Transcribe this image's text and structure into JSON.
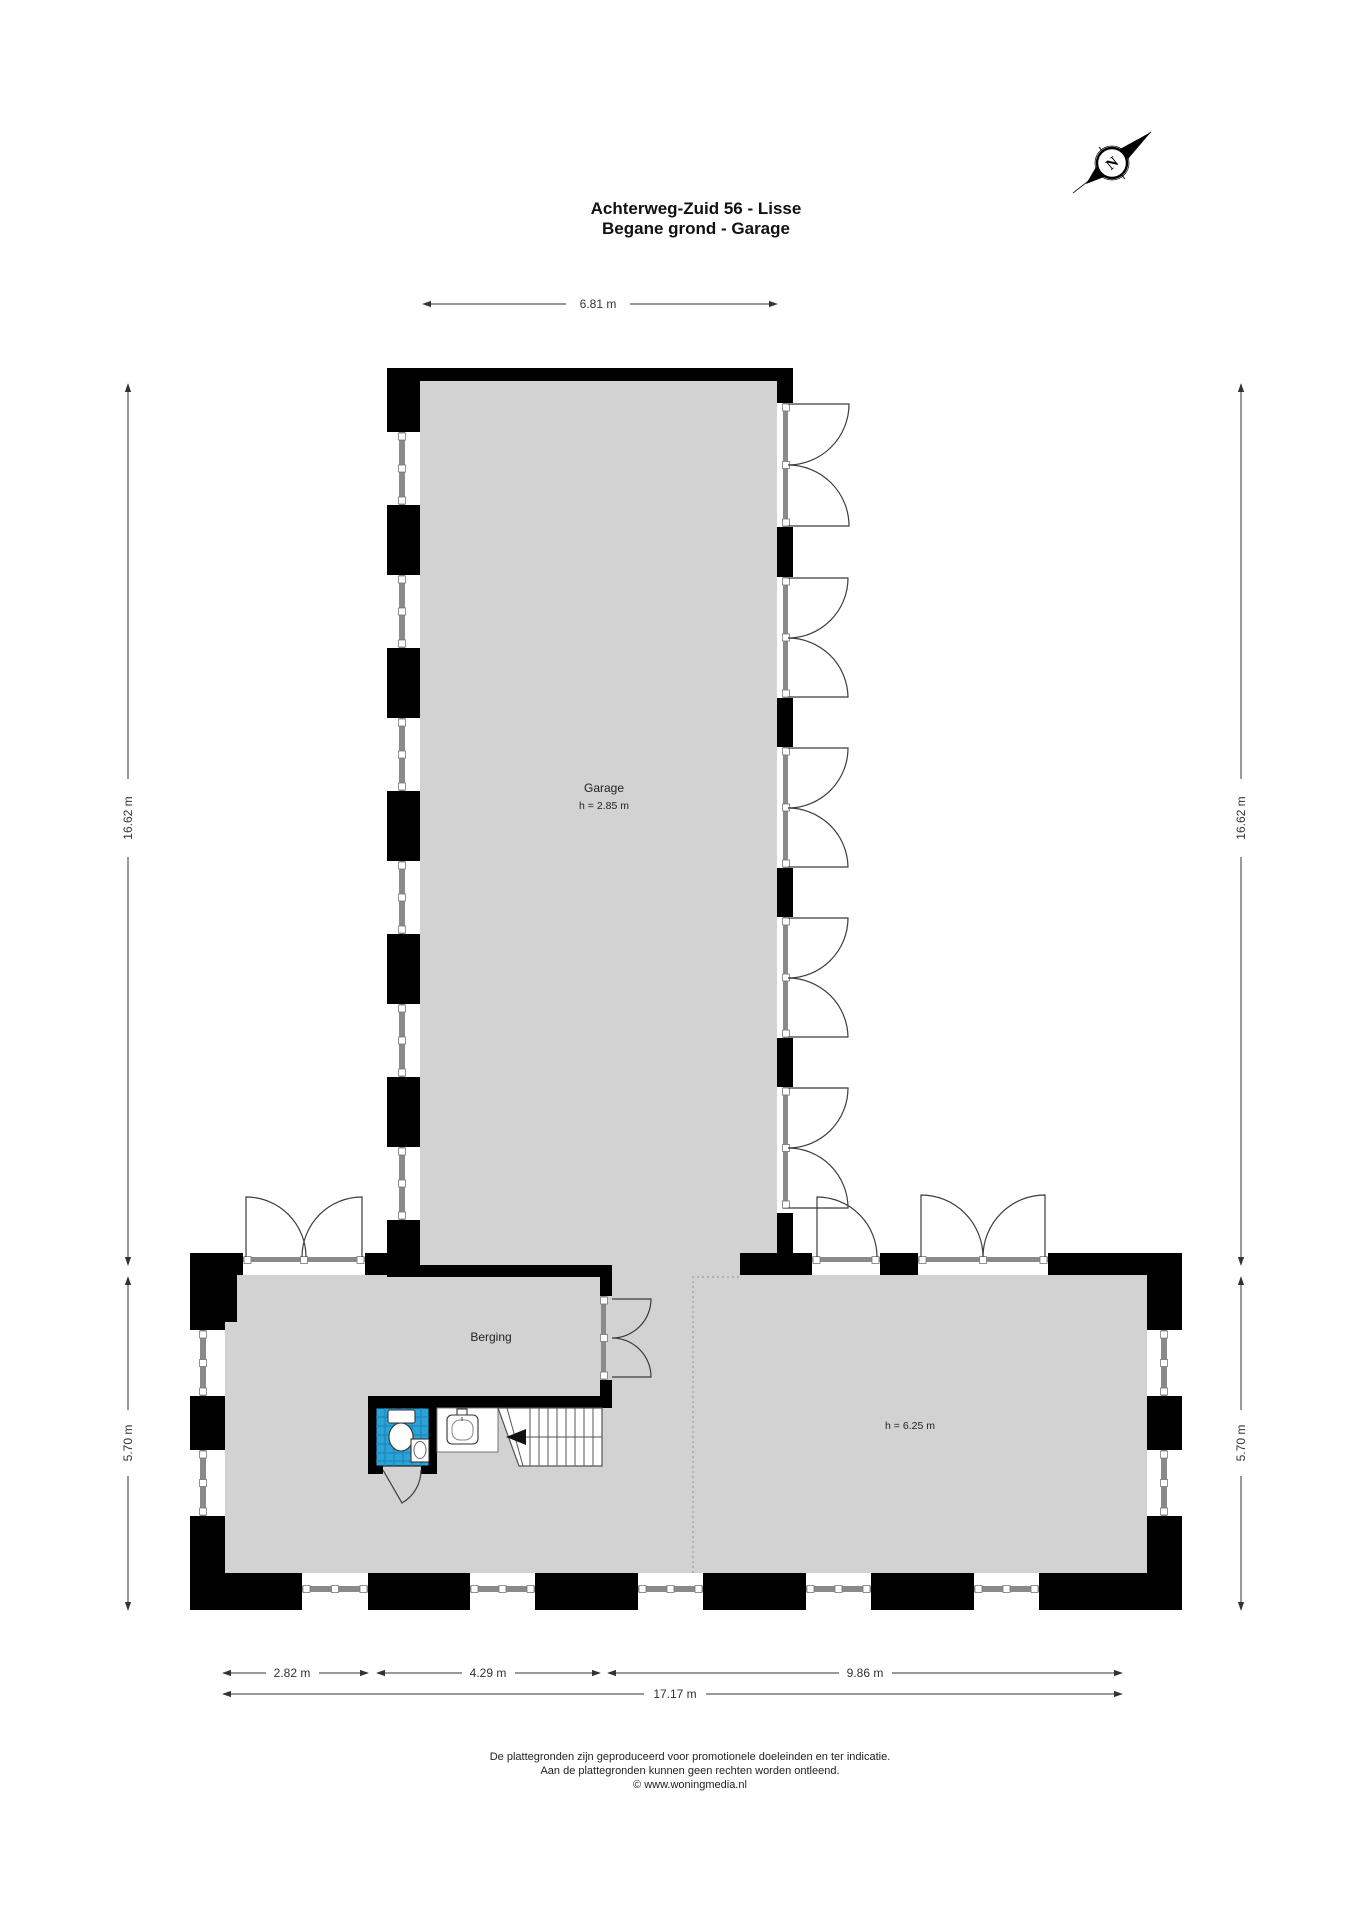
{
  "title": {
    "line1": "Achterweg-Zuid 56 - Lisse",
    "line2": "Begane grond - Garage"
  },
  "compass": {
    "label": "N"
  },
  "rooms": {
    "garage": {
      "name": "Garage",
      "height_label": "h = 2.85 m"
    },
    "berging": {
      "name": "Berging"
    },
    "main_space": {
      "height_label": "h = 6.25 m"
    }
  },
  "dimensions": {
    "top_width": "6.81 m",
    "left_upper_height": "16.62 m",
    "left_lower_height": "5.70 m",
    "right_upper_height": "16.62 m",
    "right_lower_height": "5.70 m",
    "bottom_segment_1": "2.82 m",
    "bottom_segment_2": "4.29 m",
    "bottom_segment_3": "9.86 m",
    "bottom_total": "17.17 m"
  },
  "footer": {
    "line1": "De plattegronden zijn geproduceerd voor promotionele doeleinden en ter indicatie.",
    "line2": "Aan de plattegronden kunnen geen rechten worden ontleend.",
    "line3": "© www.woningmedia.nl"
  },
  "colors": {
    "floor": "#d2d2d2",
    "wall": "#000000",
    "tile_blue": "#2aa3d8",
    "tile_grid": "#1b82b2",
    "frame_gray": "#8a8a8a",
    "dim": "#333333",
    "dashed": "#9a9a9a"
  }
}
